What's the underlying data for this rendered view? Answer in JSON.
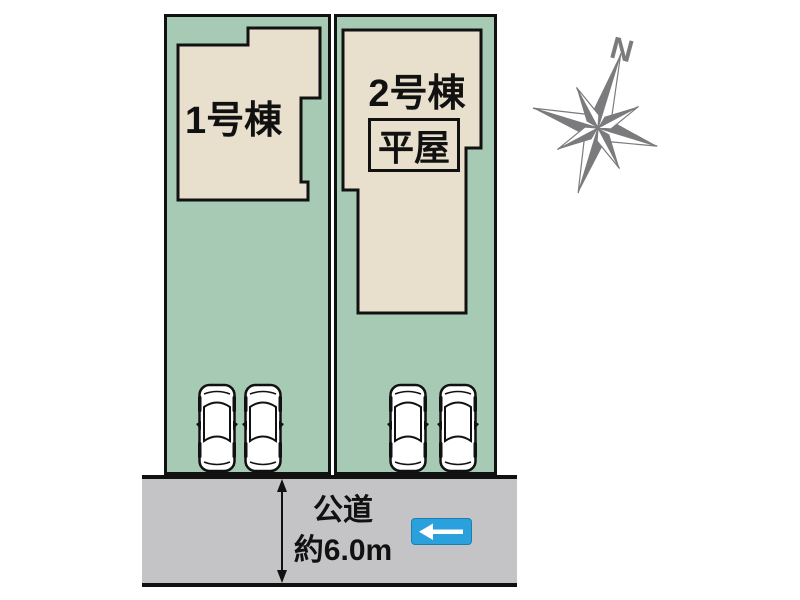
{
  "site_plan": {
    "lots": [
      {
        "label": "1号棟",
        "cars_parked": 2
      },
      {
        "label": "2号棟",
        "badge": "平屋",
        "cars_parked": 2
      }
    ],
    "road": {
      "label_line1": "公道",
      "label_line2": "約6.0m"
    },
    "compass": {
      "north_label": "N"
    },
    "icons": {
      "car": "car-top-view-icon",
      "road_sign": "left-arrow-road-sign-icon",
      "compass": "compass-rose-icon",
      "dimension": "road-width-dimension-arrow"
    },
    "colors": {
      "lot_fill": "#a6cab3",
      "building_fill": "#e8e0cd",
      "road_fill": "#c4c4c6",
      "outline": "#111111",
      "sign_blue": "#2aa0dc",
      "compass_gray": "#7b7b7d"
    }
  }
}
